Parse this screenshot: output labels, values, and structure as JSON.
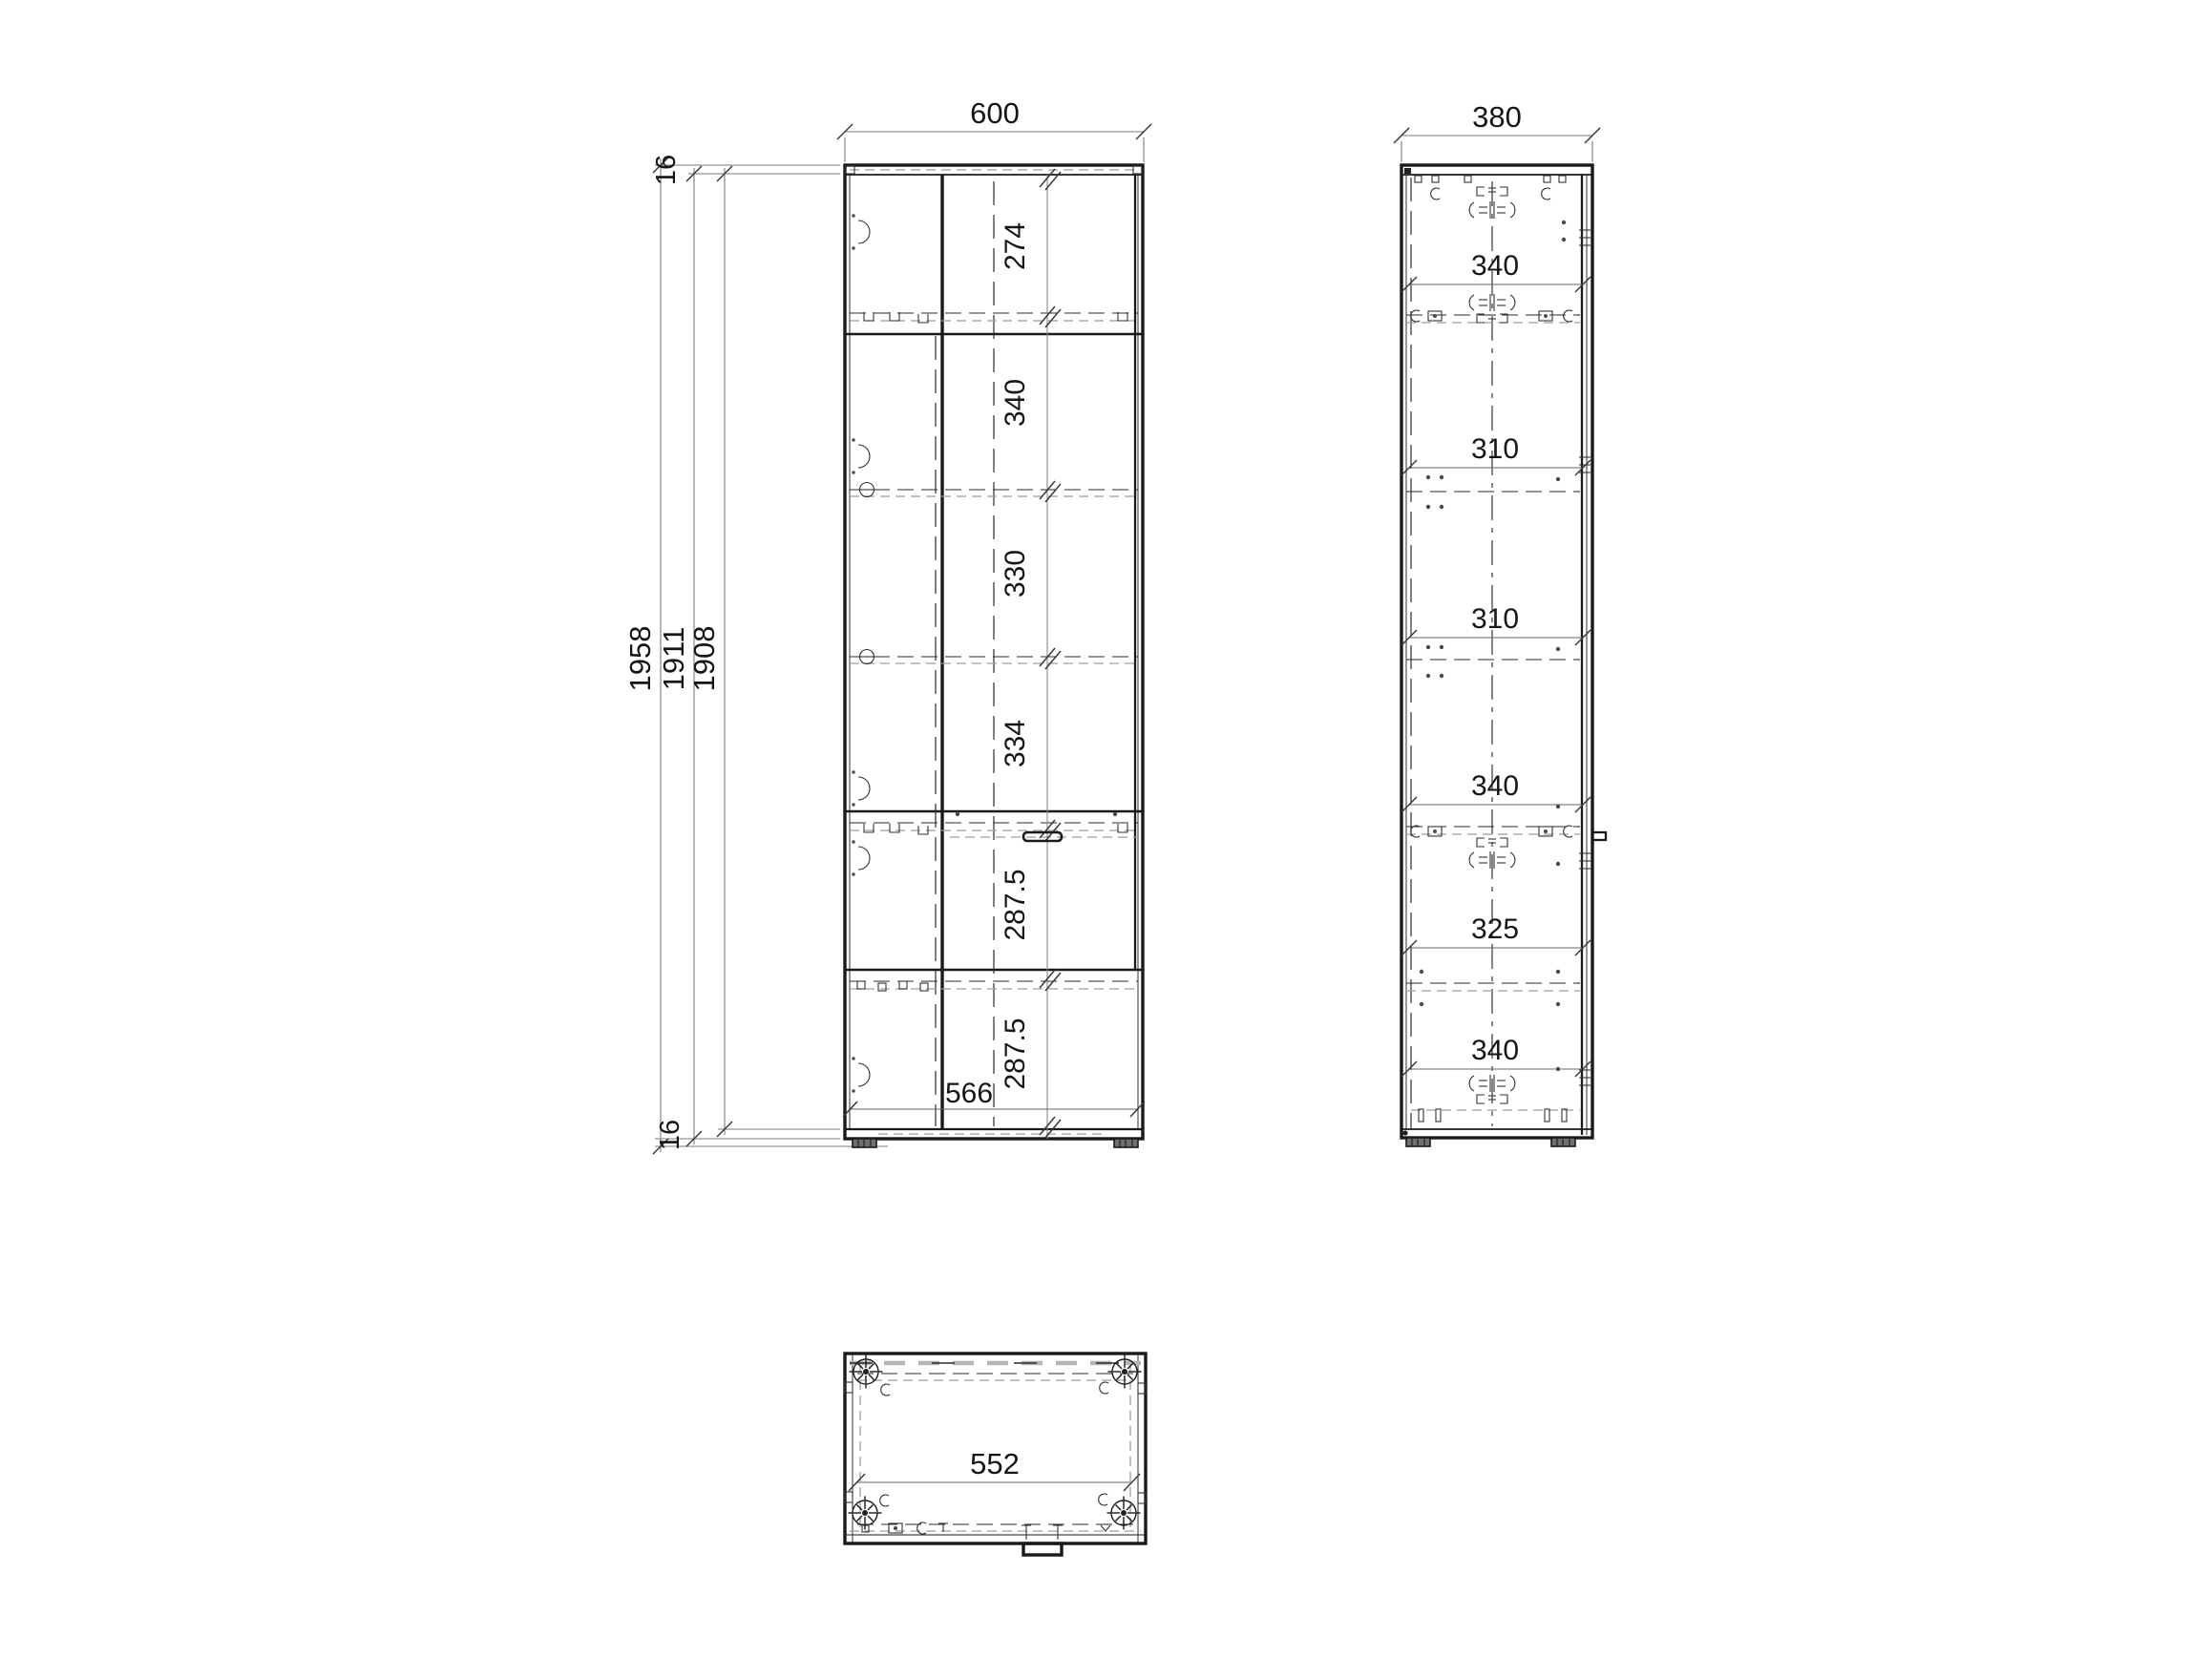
{
  "page": {
    "background": "#ffffff"
  },
  "colors": {
    "line": "#1a1a1a",
    "dimension_line": "#7a7a7a",
    "dashed_gray": "#9e9e9e",
    "text": "#161616"
  },
  "front_view": {
    "width_mm": "600",
    "top_panel_mm": "16",
    "bottom_panel_mm": "16",
    "overall_heights_mm": [
      "1958",
      "1911",
      "1908"
    ],
    "section_heights_mm": [
      "274",
      "340",
      "330",
      "334",
      "287.5",
      "287.5"
    ],
    "door_inner_width_mm": "566"
  },
  "side_view": {
    "depth_mm": "380",
    "section_heights_mm": [
      "340",
      "310",
      "310",
      "340",
      "325",
      "340"
    ]
  },
  "bottom_view": {
    "inner_width_mm": "552"
  }
}
